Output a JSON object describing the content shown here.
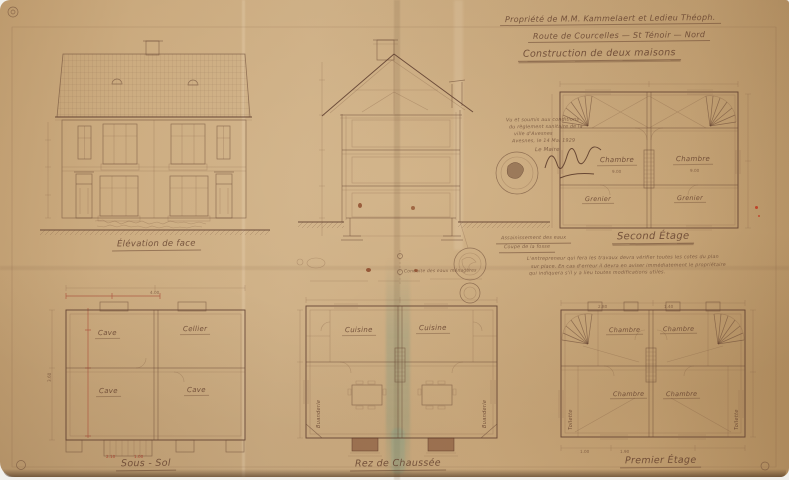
{
  "colors": {
    "paper": "#c9a87c",
    "ink": "#6e4a38",
    "red_ink": "#a8503f",
    "stain_green": "#8fa08a"
  },
  "title_block": {
    "line1": "Propriété de M.M. Kammelaert et Ledieu Théoph.",
    "line2": "Route de Courcelles — St Ténoir — Nord",
    "line3": "Construction de deux maisons"
  },
  "approval_note": {
    "line1": "Vu et soumis aux conditions",
    "line2": "du règlement sanitaire de la",
    "line3": "ville d'Avesnes",
    "line4": "Avesnes, le 14 Mai 1929",
    "line5": "Le Maire"
  },
  "captions": {
    "elevation": "Élévation de face",
    "second_floor": "Second Étage",
    "basement": "Sous - Sol",
    "ground_floor": "Rez de Chaussée",
    "first_floor": "Premier Étage",
    "section_note1": "Assainissement des eaux",
    "section_note2": "Coupe de la fosse",
    "pipe_note": "Conduite des eaux ménagères"
  },
  "paragraph": {
    "line1": "L'entrepreneur qui fera les travaux devra vérifier toutes les cotes du plan",
    "line2": "sur place. En cas d'erreur il devra en aviser immédiatement le propriétaire",
    "line3": "qui indiquera s'il y a lieu toutes modifications utiles."
  },
  "plans": {
    "second": {
      "rooms": [
        "Chambre",
        "Chambre",
        "Grenier",
        "Grenier"
      ],
      "areas": [
        "9.00",
        "9.00"
      ]
    },
    "basement": {
      "rooms": [
        "Cave",
        "Cellier",
        "Cave",
        "Cave"
      ]
    },
    "ground": {
      "rooms": [
        "Cuisine",
        "Cuisine"
      ],
      "side_rooms": [
        "Buanderie",
        "Buanderie"
      ]
    },
    "first": {
      "rooms": [
        "Chambre",
        "Chambre",
        "Chambre",
        "Chambre"
      ],
      "side_rooms": [
        "Toilette",
        "Toilette"
      ]
    }
  },
  "dimensions": {
    "samples": [
      "2.80",
      "1.40",
      "1.00",
      "1.90",
      "2.10",
      "1.00",
      "3.60",
      "4.00"
    ]
  }
}
